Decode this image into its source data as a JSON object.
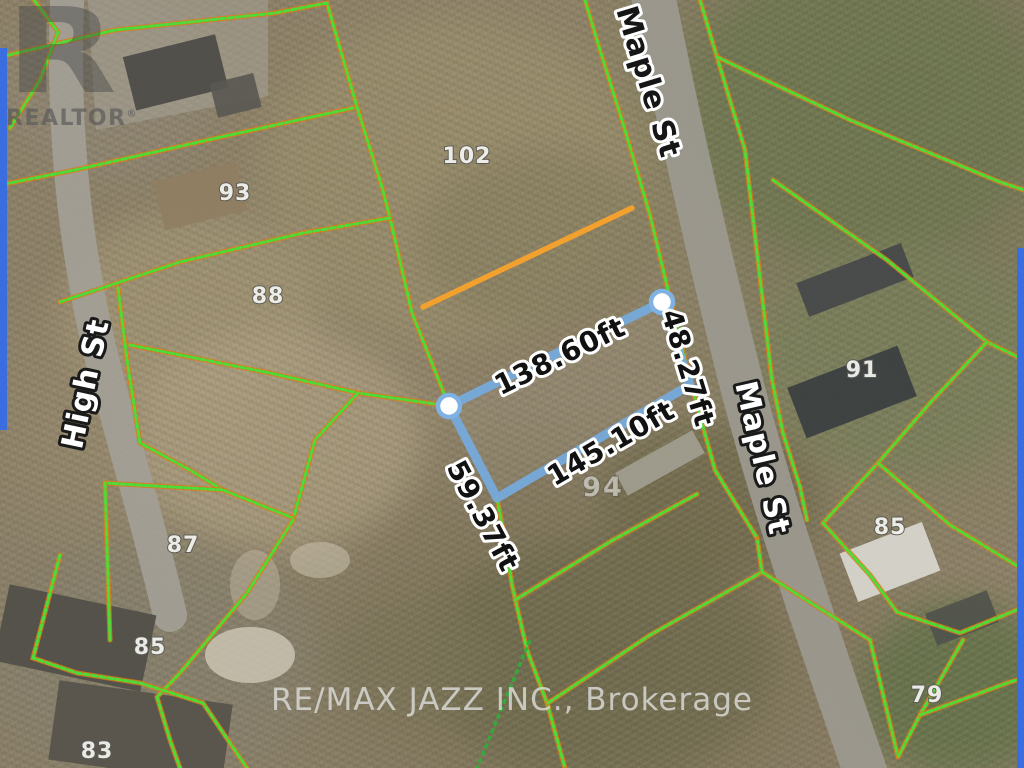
{
  "canvas": {
    "width": "1024",
    "height": "768"
  },
  "watermarks": {
    "realtor_logo_letter": "R",
    "realtor_text": "REALTOR",
    "realtor_reg": "®",
    "brokerage": "RE/MAX JAZZ INC., Brokerage"
  },
  "streets": {
    "maple_top": "Maple St",
    "maple_right": "Maple St",
    "high": "High St"
  },
  "measurements": {
    "top": "138.60ft",
    "right": "48.27ft",
    "bottom": "145.10ft",
    "left": "59.37ft"
  },
  "lots": {
    "l102": "102",
    "l93": "93",
    "l88": "88",
    "l91": "91",
    "l87": "87",
    "l85_west": "85",
    "l83": "83",
    "l94": "94",
    "l85_east": "85",
    "l79": "79"
  },
  "colors": {
    "parcel_green": "#46e03c",
    "parcel_casing": "#e07818",
    "parcel_dark_green": "#2fae3a",
    "highlight_orange": "#f2a12e",
    "lot_blue": "#76abdf",
    "handle_ring": "#7fb2e2",
    "edge_bar_blue": "#3a6de0"
  }
}
